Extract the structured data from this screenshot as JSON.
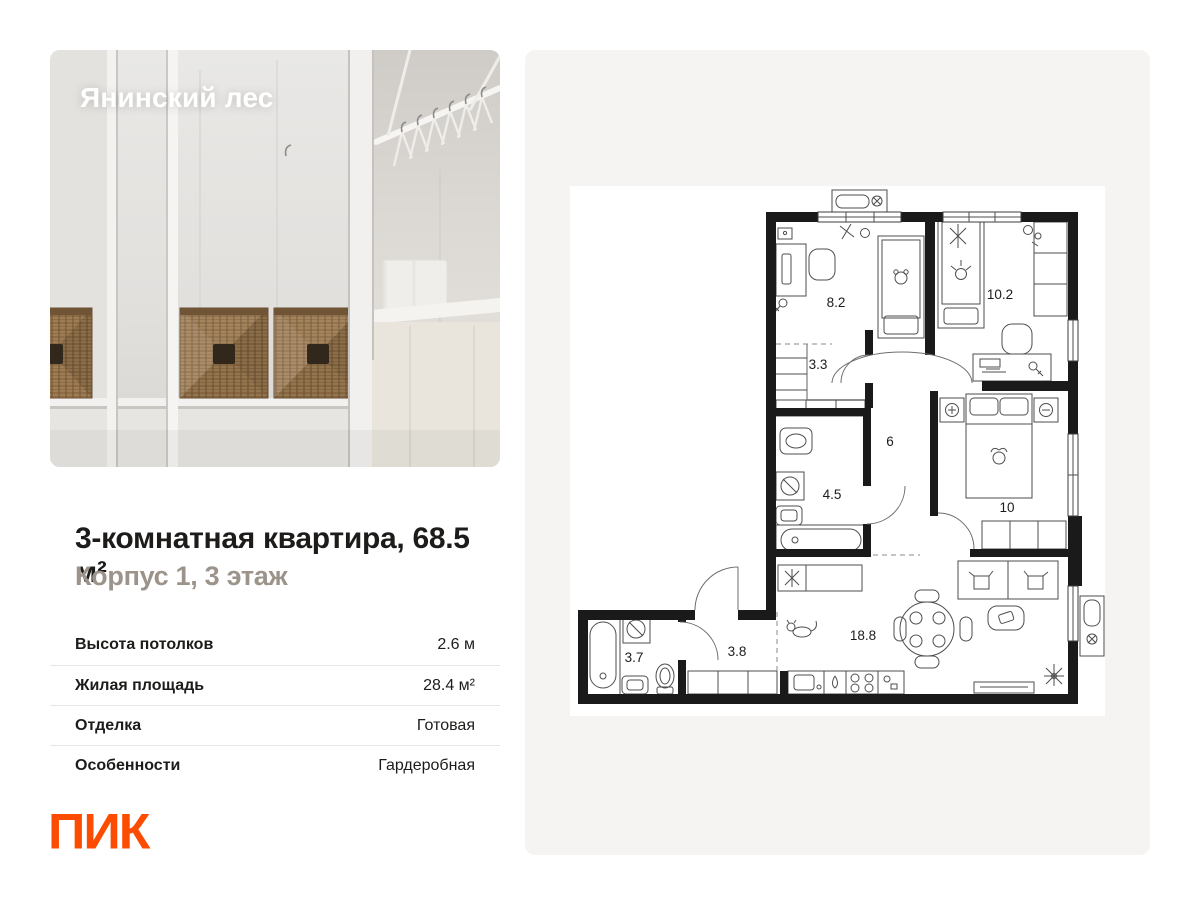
{
  "listing": {
    "project_name": "Янинский лес",
    "title": "3-комнатная квартира, 68.5 м²",
    "subtitle": "Корпус 1, 3 этаж",
    "specs": [
      {
        "label": "Высота потолков",
        "value": "2.6 м"
      },
      {
        "label": "Жилая площадь",
        "value": "28.4 м²"
      },
      {
        "label": "Отделка",
        "value": "Готовая"
      },
      {
        "label": "Особенности",
        "value": "Гардеробная"
      }
    ],
    "brand": {
      "name": "ПИК",
      "color": "#fc4c02"
    }
  },
  "floor_plan": {
    "rooms": [
      {
        "name": "bedroom-1",
        "area": "8.2"
      },
      {
        "name": "bedroom-2",
        "area": "10.2"
      },
      {
        "name": "wardrobe",
        "area": "3.3"
      },
      {
        "name": "corridor",
        "area": "6"
      },
      {
        "name": "bathroom",
        "area": "4.5"
      },
      {
        "name": "bedroom-3",
        "area": "10"
      },
      {
        "name": "bathroom-2",
        "area": "3.7"
      },
      {
        "name": "entry-hall",
        "area": "3.8"
      },
      {
        "name": "kitchen-living",
        "area": "18.8"
      }
    ],
    "colors": {
      "walls": "#1a1a1a",
      "paper": "#ffffff",
      "panel": "#f5f4f2"
    }
  }
}
